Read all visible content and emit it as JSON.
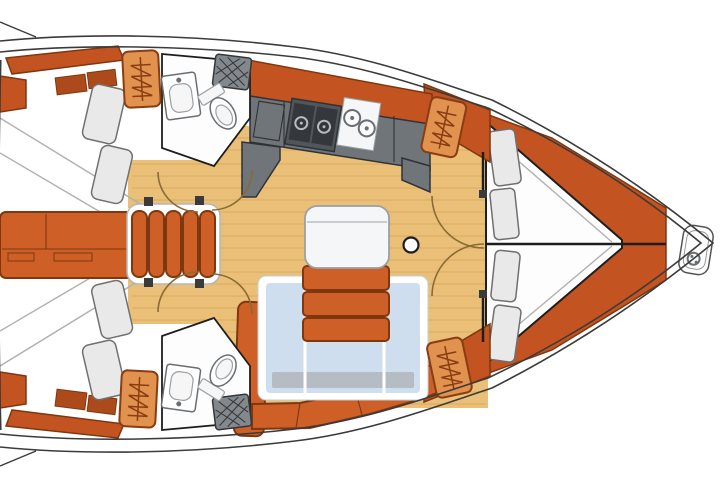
{
  "meta": {
    "title": "sailboat-interior-floor-plan",
    "type": "yacht deck layout diagram"
  },
  "colors": {
    "bg": "#ffffff",
    "hull_line": "#3b3b3b",
    "floor_wood": "#eac078",
    "floor_grain": "#d09c52",
    "orange": "#cd5f27",
    "orange_dark": "#7e3810",
    "orange_deep": "#c35320",
    "orange_light": "#e0924e",
    "hatch_border": "#8a3c12",
    "cubby": "#ad4a1c",
    "counter": "#70757a",
    "counter_line": "#2f3337",
    "appliance": "#34383c",
    "appliance_frame": "#51565a",
    "burner": "#b9bcbe",
    "sink_white": "#f4f6f7",
    "white": "#fdfdfd",
    "outline_dark": "#1e1e1e",
    "pillow": "#e9e9e9",
    "pillow_line": "#707070",
    "table_blue": "#cfdeee",
    "table_gray": "#b6bcc4",
    "table_edge": "#c6ccd2",
    "seat_white": "#f4f6f8",
    "seat_line": "#9aa0a5",
    "grate": "#83888d",
    "grate_line": "#33373b",
    "arc": "#8a6a35",
    "fixture_line": "#6a6e72",
    "fixture_light": "#9aa0a4",
    "seam_gray": "#b0b0b0",
    "tick_dark": "#3a3a3a",
    "steps_box": "#b5b5b5"
  },
  "regions": {
    "aft_cabin_starboard": "aft-cabin-starboard",
    "aft_cabin_port": "aft-cabin-port",
    "aft_head_starboard": "aft-head-starboard",
    "aft_head_port": "aft-head-port",
    "galley": "galley",
    "salon": "salon",
    "salon_table": "salon-table",
    "salon_bench": "salon-bench",
    "companionway_steps": "companionway-steps",
    "engine_compartment": "engine-compartment",
    "forward_cabin": "forward-cabin",
    "v_berth": "v-berth",
    "anchor_locker": "anchor-locker",
    "mast_post": "mast-post"
  },
  "counts": {
    "deck_hatches": 4,
    "v_berth_pillows": 4,
    "aft_cabin_pillows": 4,
    "companionway_treads": 5
  },
  "icons": {
    "ladder_hatch": "ladder-hatch-icon",
    "windlass": "windlass-icon",
    "stove": "stove-burners-icon",
    "sinks": "twin-sinks-icon",
    "toilet": "toilet-icon",
    "shower_grate": "shower-grate-icon",
    "door_swing": "door-swing-arc"
  }
}
